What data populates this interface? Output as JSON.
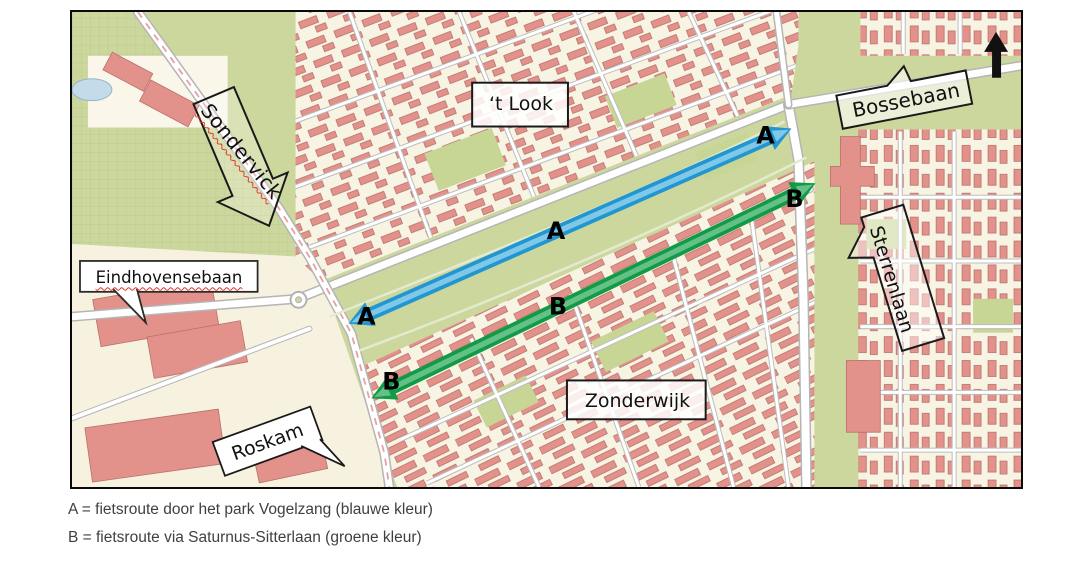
{
  "page": {
    "background": "#ffffff"
  },
  "map": {
    "area_labels": [
      {
        "id": "t-look",
        "text": "‘t Look"
      },
      {
        "id": "zonderwijk",
        "text": "Zonderwijk"
      }
    ],
    "street_labels": [
      {
        "id": "sondervick",
        "text": "Sondervick",
        "spellcheck_underline": true
      },
      {
        "id": "bossebaan",
        "text": "Bossebaan",
        "spellcheck_underline": false
      },
      {
        "id": "eindhovensebaan",
        "text": "Eindhovensebaan",
        "spellcheck_underline": true
      },
      {
        "id": "sterrenlaan",
        "text": "Sterrenlaan",
        "spellcheck_underline": false
      },
      {
        "id": "roskam",
        "text": "Roskam",
        "spellcheck_underline": false
      }
    ],
    "routes": [
      {
        "label": "A",
        "description": "fietsroute door het park Vogelzang",
        "color": "#2196d0",
        "color_light": "#7fc8e8"
      },
      {
        "label": "B",
        "description": "fietsroute via Saturnus-Sitterlaan",
        "color": "#129a47",
        "color_light": "#63c187"
      }
    ],
    "north_arrow_icon": "north-arrow",
    "palette": {
      "field_green": "#ccd79d",
      "urban_cream": "#f8f4e4",
      "building_red": "#e2918b",
      "road_white": "#ffffff",
      "road_casing": "#b5b5b5",
      "water_blue": "#c4dcea",
      "border_black": "#0a0a0a"
    }
  },
  "legend": {
    "lines": [
      "A = fietsroute door het park Vogelzang (blauwe kleur)",
      "B = fietsroute via Saturnus-Sitterlaan (groene kleur)"
    ]
  }
}
